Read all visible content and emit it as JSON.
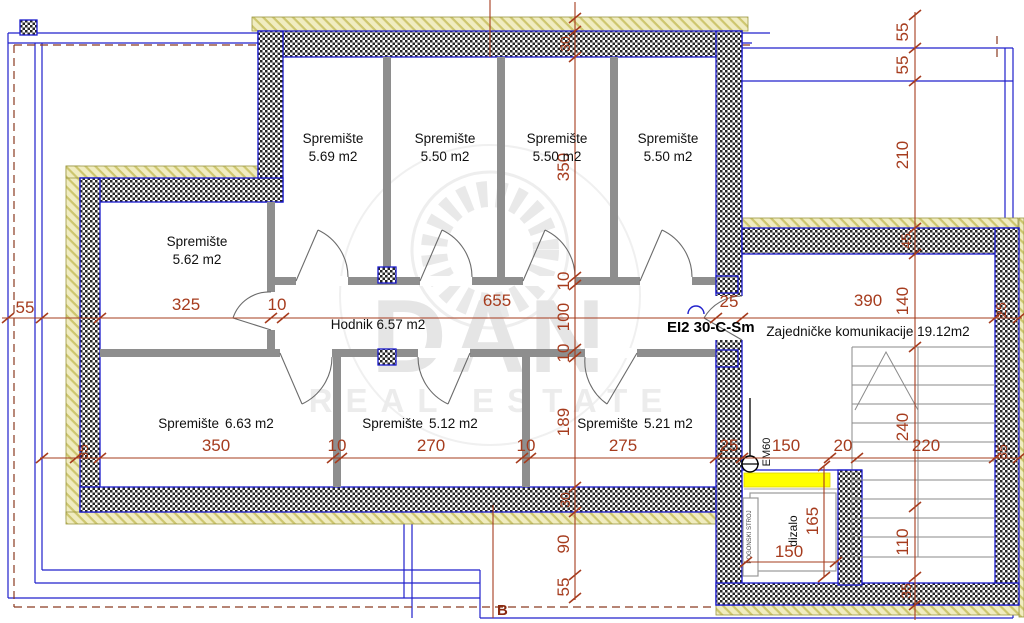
{
  "watermark": {
    "title": "DAN",
    "subtitle": "REAL ESTATE"
  },
  "rooms": {
    "s1": {
      "name": "Spremište",
      "area": "5.69 m2"
    },
    "s2": {
      "name": "Spremište",
      "area": "5.50 m2"
    },
    "s3": {
      "name": "Spremište",
      "area": "5.50 m2"
    },
    "s4": {
      "name": "Spremište",
      "area": "5.50 m2"
    },
    "s5": {
      "name": "Spremište",
      "area": "5.62 m2"
    },
    "s6": {
      "name": "Spremište",
      "area": "6.63 m2"
    },
    "s7": {
      "name": "Spremište",
      "area": "5.12 m2"
    },
    "s8": {
      "name": "Spremište",
      "area": "5.21 m2"
    },
    "hodnik": {
      "label": "Hodnik 6.57 m2"
    },
    "zajednicke": {
      "label": "Zajedničke komunikacije 19.12m2"
    },
    "dizalo": {
      "label": "dizalo"
    },
    "pogonski": {
      "label": "POGONSKI STROJ"
    }
  },
  "labels": {
    "fire_rating": "EI2 30-C-Sm",
    "vent": "EM60",
    "section_mark": "B"
  },
  "dims": {
    "h1": [
      "55",
      "325",
      "10",
      "655",
      "25",
      "390",
      "25"
    ],
    "h2": [
      "35",
      "350",
      "10",
      "270",
      "10",
      "275",
      "25",
      "150",
      "20",
      "220",
      "35"
    ],
    "v1": [
      "30",
      "350",
      "10",
      "100",
      "10",
      "189",
      "30",
      "90",
      "55"
    ],
    "v2": [
      "55",
      "55",
      "210",
      "45",
      "140",
      "240",
      "110",
      "35"
    ],
    "lift": [
      "165",
      "150"
    ]
  },
  "colors": {
    "wall_outline": "#1a1acc",
    "dimension": "#a63c1e",
    "insulation": "#f0ecc0",
    "highlight": "#ffff00",
    "partition": "#8e8e8e"
  }
}
